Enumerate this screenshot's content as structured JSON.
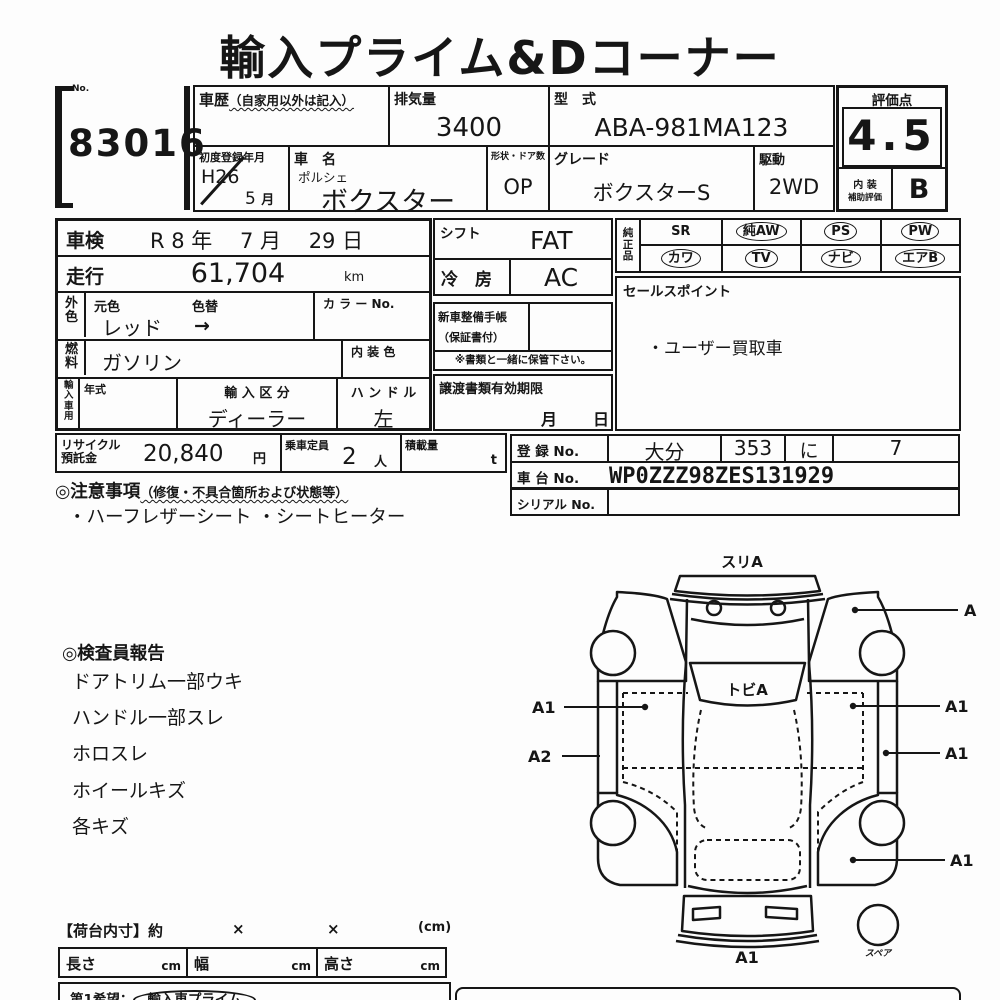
{
  "title": "輸入プライム&Dコーナー",
  "lot": {
    "label": "No.",
    "number": "83016"
  },
  "header": {
    "history_label": "車歴",
    "history_note": "（自家用以外は記入）",
    "displacement_label": "排気量",
    "displacement_value": "3400",
    "model_label": "型　式",
    "model_value": "ABA-981MA123",
    "first_reg_label": "初度登録年月",
    "first_reg_era_year": "H26",
    "first_reg_month": "5",
    "first_reg_month_suffix": "月",
    "name_label": "車　名",
    "maker": "ポルシェ",
    "name_value": "ボクスター",
    "shape_label": "形状・ドア数",
    "shape_value": "OP",
    "grade_label": "グレード",
    "grade_value": "ボクスターS",
    "drive_label": "駆動",
    "drive_value": "2WD"
  },
  "rating": {
    "score_label": "評価点",
    "score": "4.5",
    "interior_label_1": "内 装",
    "interior_label_2": "補助評価",
    "interior_grade": "B"
  },
  "detail": {
    "shaken_label": "車検",
    "shaken_value": "R 8 年　 7 月　 29 日",
    "mileage_label": "走行",
    "mileage_value": "61,704",
    "mileage_unit": "km",
    "ext_color_label": "外色",
    "orig_color_label": "元色",
    "color_change_label": "色替",
    "orig_color": "レッド",
    "arrow": "→",
    "color_no_label": "カ ラ ー No.",
    "fuel_label": "燃料",
    "fuel_value": "ガソリン",
    "interior_color_label": "内 装 色",
    "import_label": "輸入車用",
    "year_label": "年式",
    "import_class_label": "輸 入 区 分",
    "import_class_value": "ディーラー",
    "handle_label": "ハ ン ド ル",
    "handle_value": "左"
  },
  "equipment": {
    "shift_label": "シフト",
    "shift_value": "FAT",
    "cooling_label": "冷　房",
    "cooling_value": "AC",
    "book_label_1": "新車整備手帳",
    "book_label_2": "（保証書付）",
    "keep_note": "※書類と一緒に保管下さい。",
    "transfer_label": "譲渡書類有効期限",
    "transfer_month": "月",
    "transfer_day": "日"
  },
  "genuine": {
    "label": "純正品",
    "items": [
      {
        "text": "SR",
        "circled": false
      },
      {
        "text": "純AW",
        "circled": true
      },
      {
        "text": "PS",
        "circled": true
      },
      {
        "text": "PW",
        "circled": true
      },
      {
        "text": "カワ",
        "circled": true
      },
      {
        "text": "TV",
        "circled": true
      },
      {
        "text": "ナビ",
        "circled": true
      },
      {
        "text": "エアB",
        "circled": true
      }
    ]
  },
  "sales_point": {
    "label": "セールスポイント",
    "text": "・ユーザー買取車"
  },
  "recycle": {
    "label_1": "リサイクル",
    "label_2": "預託金",
    "value": "20,840",
    "unit": "円",
    "capacity_label": "乗車定員",
    "capacity_value": "2",
    "capacity_unit": "人",
    "load_label": "積載量",
    "load_unit": "t"
  },
  "registration": {
    "reg_label": "登 録 No.",
    "reg_area": "大分",
    "reg_class": "353",
    "reg_kana": "に",
    "reg_number": "7",
    "chassis_label": "車 台 No.",
    "chassis_value": "WP0ZZZ98ZES131929",
    "serial_label": "シリアル No."
  },
  "cautions": {
    "heading": "◎注意事項",
    "heading_note": "（修復・不具合箇所および状態等）",
    "text": "・ハーフレザーシート ・シートヒーター"
  },
  "inspector": {
    "heading": "◎検査員報告",
    "items": [
      "ドアトリム一部ウキ",
      "ハンドル一部スレ",
      "ホロスレ",
      "ホイールキズ",
      "各キズ"
    ]
  },
  "diagram": {
    "front_label": "スリA",
    "windshield_label": "トビA",
    "spare_label": "スペア",
    "marks": {
      "right_fender": "A",
      "left_door": "A1",
      "right_door": "A1",
      "left_rocker": "A2",
      "right_rocker": "A1",
      "right_rear": "A1",
      "rear_bumper": "A1"
    }
  },
  "cargo": {
    "heading": "【荷台内寸】約",
    "times1": "×",
    "times2": "×",
    "unit": "(cm)",
    "length_label": "長さ",
    "width_label": "幅",
    "height_label": "高さ",
    "cm": "cm"
  },
  "footer": {
    "wish_label": "第1希望：",
    "wish_value": "輸入車プライム"
  }
}
